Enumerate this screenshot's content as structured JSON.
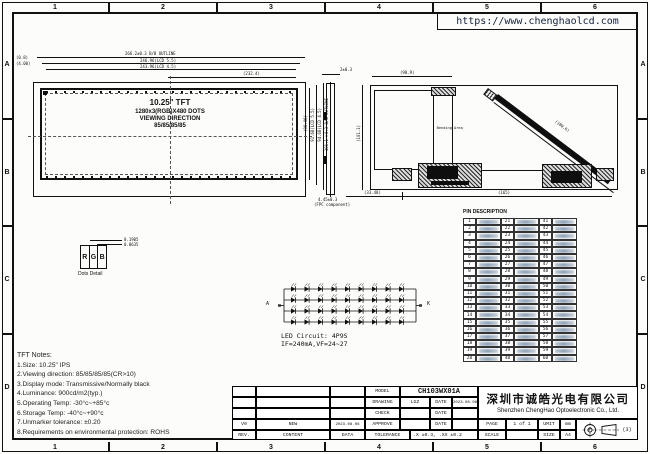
{
  "header": {
    "url": "https://www.chenghaolcd.com"
  },
  "frame": {
    "cols": [
      "1",
      "2",
      "3",
      "4",
      "5",
      "6"
    ],
    "rows": [
      "A",
      "B",
      "C",
      "D"
    ]
  },
  "front_view": {
    "line1": "10.25\" TFT",
    "line2": "1280x3(RGB)X480 DOTS",
    "line3": "VIEWING DIRECTION",
    "line4": "85/85/85/85",
    "dim_outline": "266.2±0.3 B/B OUTLINE",
    "dim_lcd55": "246.96(LCD 5.5)",
    "dim_lcd45": "243.96(LCD 4.5)",
    "dim_232": "(232.4)",
    "dim_left1": "(0.8)",
    "dim_left2": "(4.00)",
    "dim_r1": "(90.96)",
    "dim_r2": "91.68(LCD 5.5)",
    "dim_r3": "94.68(LCD 4.5)",
    "dim_r4": "101.1±0.3 B/B OUTLINE"
  },
  "dot_detail": {
    "r": "R",
    "g": "G",
    "b": "B",
    "caption": "Dots Detail",
    "dim1": "0.1905",
    "dim2": "0.0635"
  },
  "side_view": {
    "dim_top": "2±0.3",
    "dim_bottom": "4.45±0.3",
    "dim_bottom2": "(FPC component)"
  },
  "back_view": {
    "bending": "Bending Area",
    "dim_top": "(98.9)",
    "dim_left": "(101.1)",
    "dim_fpc": "(180.6)",
    "dim_b1": "(33.48)",
    "dim_b2": "(165)"
  },
  "pin_table": {
    "title": "PIN DESCRIPTION",
    "col1": [
      "1",
      "2",
      "3",
      "4",
      "5",
      "6",
      "7",
      "8",
      "9",
      "10",
      "11",
      "12",
      "13",
      "14",
      "15",
      "16",
      "17",
      "18",
      "19",
      "20"
    ],
    "col2": [
      "21",
      "22",
      "23",
      "24",
      "25",
      "26",
      "27",
      "28",
      "29",
      "30",
      "31",
      "32",
      "33",
      "34",
      "35",
      "36",
      "37",
      "38",
      "39",
      "40"
    ],
    "col3": [
      "41",
      "42",
      "43",
      "44",
      "45",
      "46",
      "47",
      "48",
      "49",
      "50",
      "51",
      "52",
      "53",
      "54",
      "55",
      "56",
      "57",
      "58",
      "59",
      "60"
    ]
  },
  "led": {
    "a": "A",
    "k": "K",
    "caption1": "LED Circuit:  4P9S",
    "caption2": "IF=240mA,VF=24~27"
  },
  "notes": {
    "title": "TFT Notes:",
    "lines": [
      "1.Size: 10.25\" IPS",
      "2.Viewing direction: 85/85/85/85(CR>10)",
      "3.Display mode: Transmissive/Normally black",
      "4.Luminance: 900cd/m2(typ.)",
      "5.Operating Temp: -30°c~+85°c",
      "6.Storage Temp: -40°c~+90°c",
      "7.Unmarker tolerance: ±0.20",
      "8.Requirements on environmental protection: ROHS"
    ]
  },
  "title_block": {
    "model_label": "MODEL",
    "model": "CH103WX01A",
    "drawing_label": "DRAWING",
    "drawing_by": "LGZ",
    "date_label": "DATE",
    "drawing_date": "2023.08.06",
    "check_label": "CHECK",
    "approve_label": "APPROVE",
    "tolerance_label": "TOLERANCE",
    "tolerance": ".X ±0.3, .XX ±0.2",
    "rev_value": "V0",
    "content_value": "NEW",
    "date_value": "2023.08.06",
    "rev_label": "REV.",
    "content_label": "CONTENT",
    "data_label": "DATA",
    "company_cn": "深圳市诚皓光电有限公司",
    "company_en": "Shenzhen ChengHao Optoelectronic Co., Ltd.",
    "page_label": "PAGE",
    "page": "1 of 1",
    "unit_label": "UMIT",
    "unit": "mm",
    "scale_label": "SCALE",
    "size_label": "SIZE",
    "size": "A4",
    "projection": "(3)"
  }
}
